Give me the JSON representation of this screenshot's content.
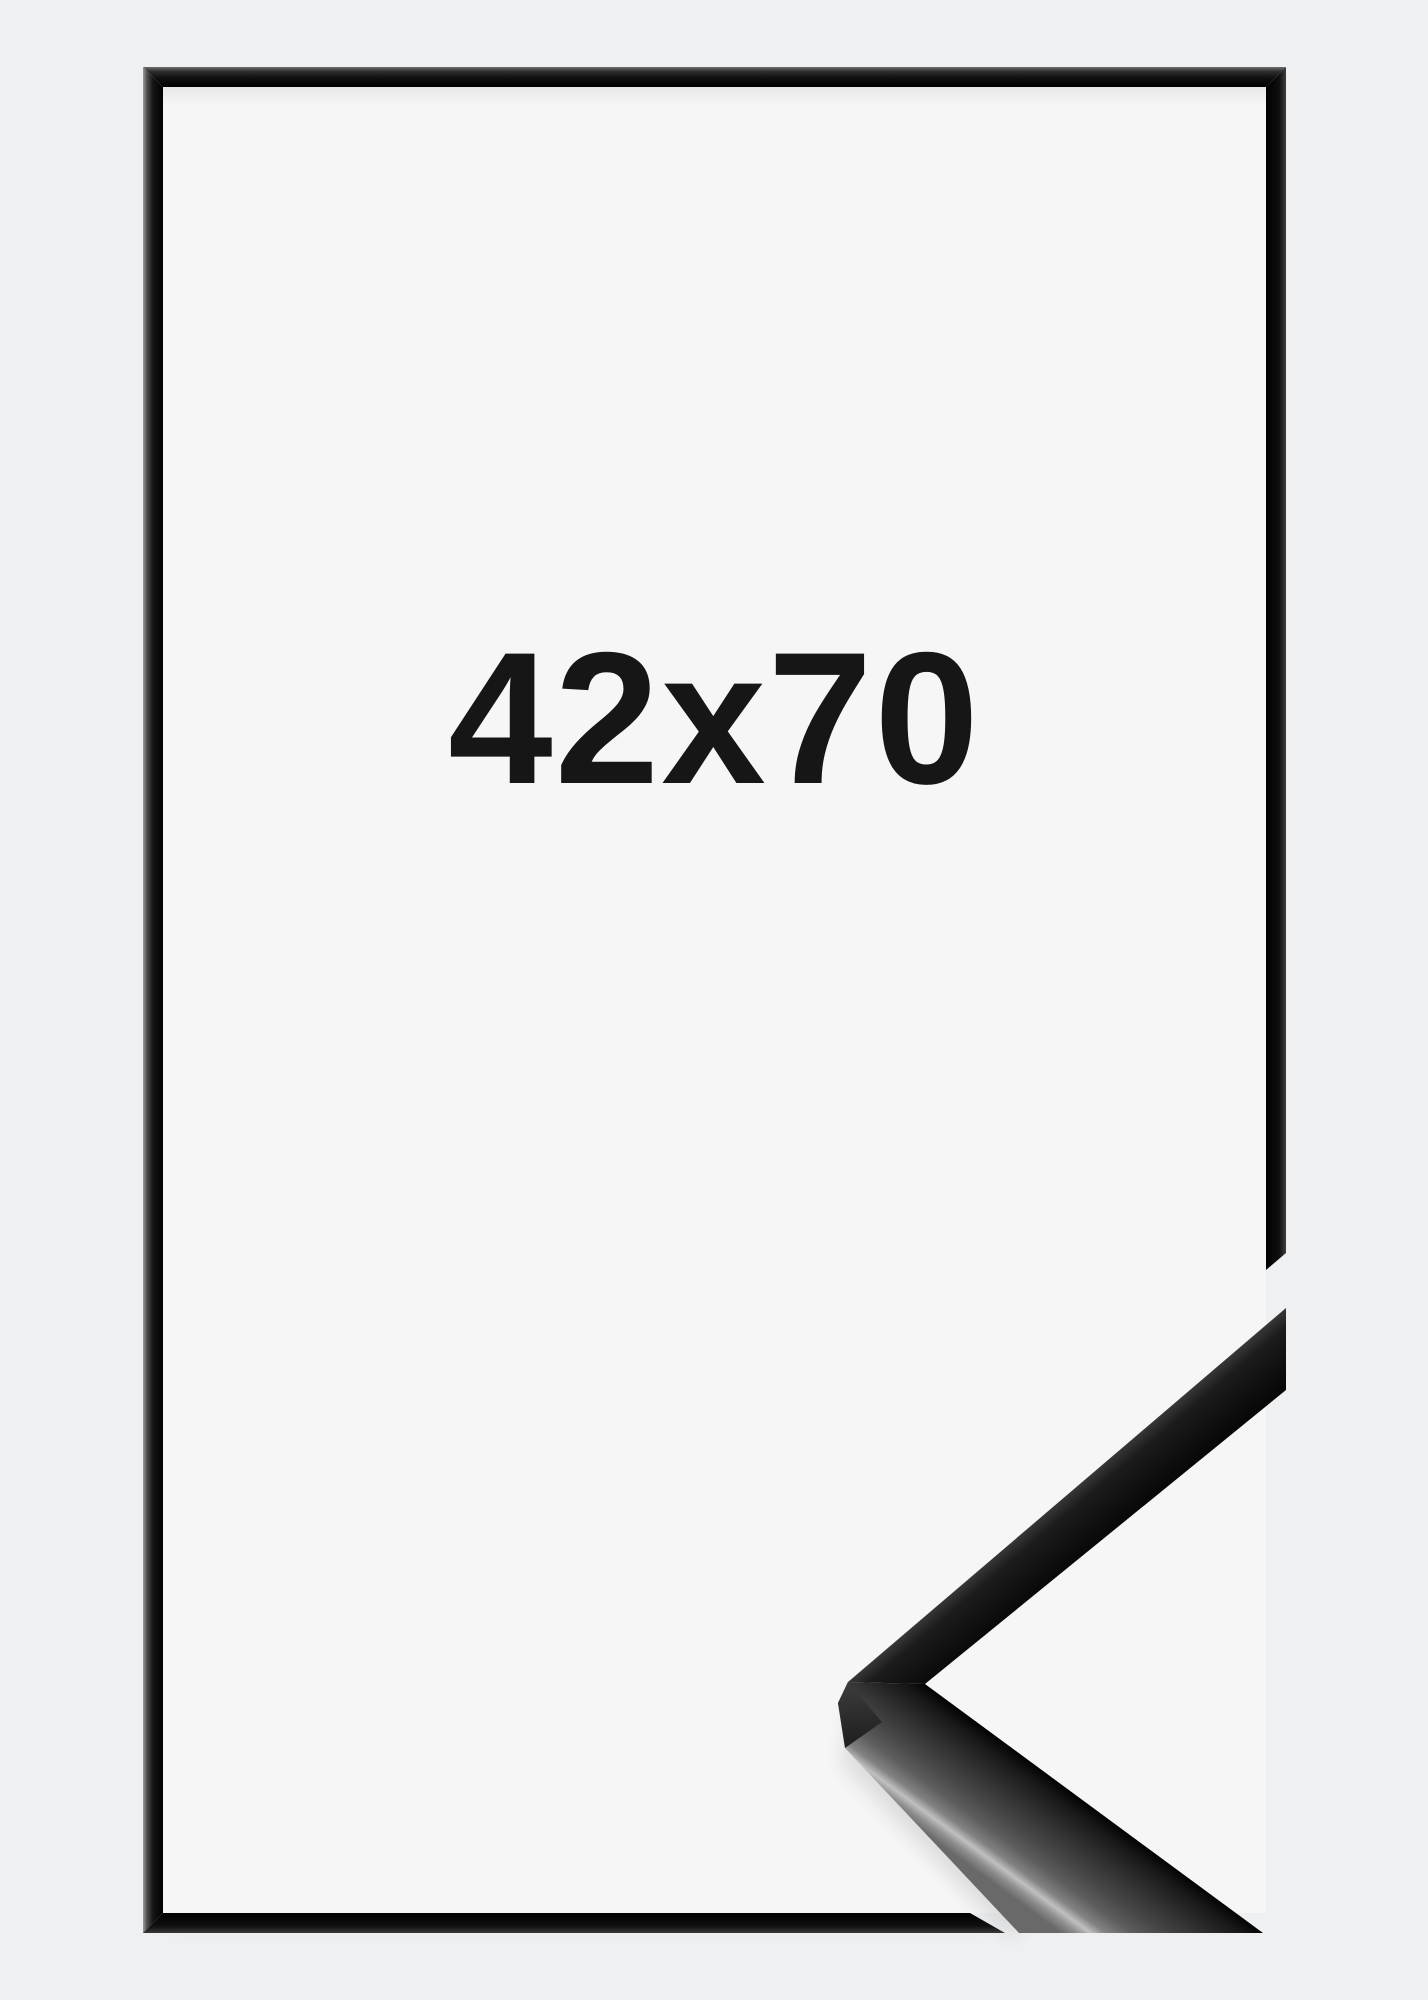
{
  "product_image": {
    "size_label": "42x70",
    "colors": {
      "bg": "#eff0f1",
      "interior": "#f6f6f7",
      "frame": "#0c0c0c",
      "label": "#161616"
    }
  }
}
